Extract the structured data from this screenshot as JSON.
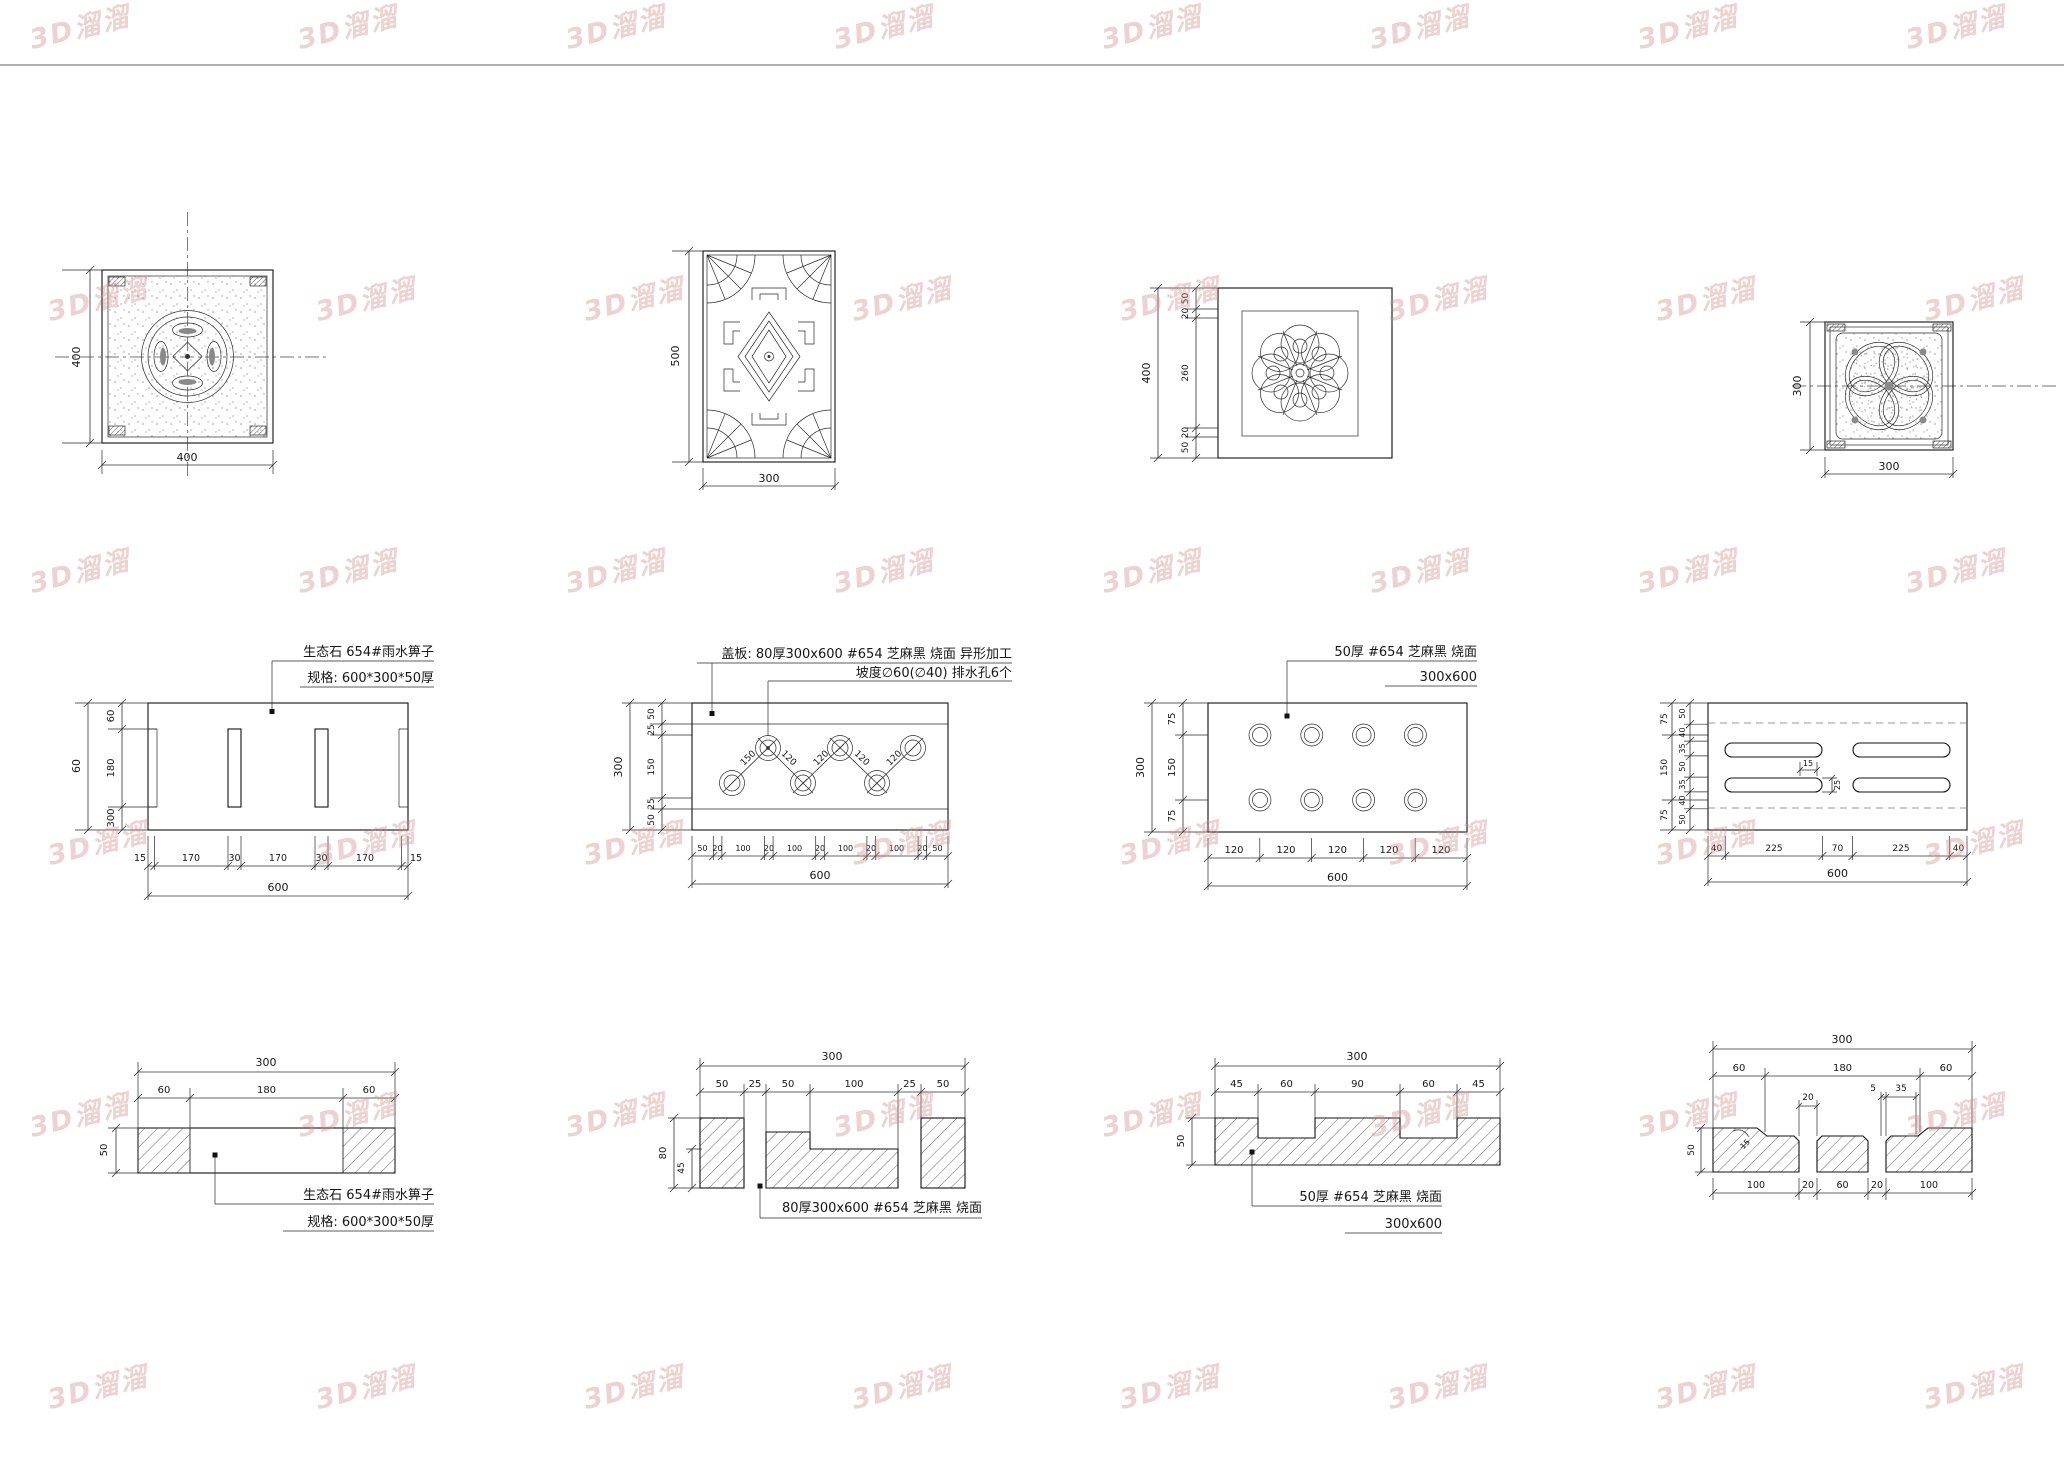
{
  "watermark": {
    "text": "3D溜溜",
    "color": "#d08a8a"
  },
  "tile1": {
    "dim_left": "400",
    "dim_bottom": "400"
  },
  "tile2": {
    "dim_left": "500",
    "dim_bottom": "300"
  },
  "tile3": {
    "dim_total": "400",
    "segs": [
      "50",
      "20",
      "260",
      "20",
      "50"
    ]
  },
  "tile4": {
    "dim_left": "300",
    "dim_bottom": "300"
  },
  "g1": {
    "note1": "生态石 654#雨水箅子",
    "note2": "规格: 600*300*50厚",
    "left_total": "300",
    "left": [
      "60",
      "180",
      "60"
    ],
    "bottom": [
      "15",
      "170",
      "30",
      "170",
      "30",
      "170",
      "15"
    ],
    "bottom_total": "600"
  },
  "g2": {
    "note1": "盖板: 80厚300x600 #654 芝麻黑 烧面  异形加工",
    "note2": "坡度∅60(∅40) 排水孔6个",
    "left_total": "300",
    "left": [
      "50",
      "25",
      "150",
      "25",
      "50"
    ],
    "bottom": [
      "50",
      "20",
      "100",
      "20",
      "100",
      "20",
      "100",
      "20",
      "100",
      "20",
      "50"
    ],
    "bottom_total": "600",
    "diag": [
      "150",
      "120",
      "120",
      "120",
      "120"
    ]
  },
  "g3": {
    "note1": "50厚 #654 芝麻黑 烧面",
    "note2": "300x600",
    "left_total": "300",
    "left": [
      "75",
      "150",
      "75"
    ],
    "bottom": [
      "120",
      "120",
      "120",
      "120",
      "120"
    ],
    "bottom_total": "600"
  },
  "g4": {
    "left_outer": [
      "75",
      "150",
      "75"
    ],
    "left": [
      "50",
      "40",
      "35",
      "50",
      "35",
      "40",
      "50"
    ],
    "bottom": [
      "40",
      "225",
      "70",
      "225",
      "40"
    ],
    "bottom_total": "600",
    "small": [
      "25",
      "15"
    ]
  },
  "s1": {
    "top_total": "300",
    "top": [
      "60",
      "180",
      "60"
    ],
    "left": "50",
    "note1": "生态石 654#雨水箅子",
    "note2": "规格: 600*300*50厚"
  },
  "s2": {
    "top_total": "300",
    "top": [
      "50",
      "25",
      "50",
      "100",
      "25",
      "50"
    ],
    "left": "80",
    "left2": "45",
    "note1": "80厚300x600 #654 芝麻黑 烧面"
  },
  "s3": {
    "top_total": "300",
    "top": [
      "45",
      "60",
      "90",
      "60",
      "45"
    ],
    "left": "50",
    "note1": "50厚 #654 芝麻黑 烧面",
    "note2": "300x600"
  },
  "s4": {
    "top_total": "300",
    "top": [
      "60",
      "180",
      "60"
    ],
    "left": "50",
    "small20": "20",
    "small5": "5",
    "small35": "35",
    "small15": "15",
    "bottom": [
      "100",
      "20",
      "60",
      "20",
      "100"
    ]
  }
}
